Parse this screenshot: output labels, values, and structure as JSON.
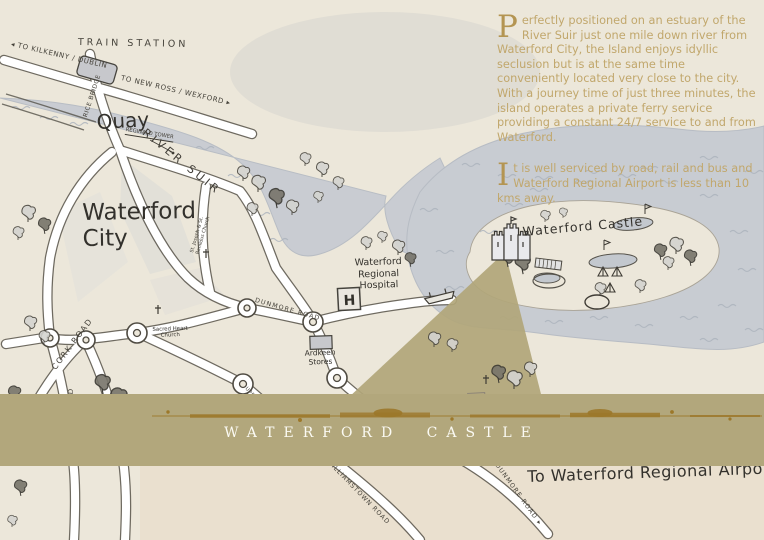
{
  "colors": {
    "background": "#ece7da",
    "water": "#c8ccd2",
    "wave": "#aab1bb",
    "road_fill": "#ffffff",
    "road_outline": "#4f4b42",
    "ink": "#33312c",
    "banner": "#b2a77c",
    "splatter": "#9c782a",
    "gold_text": "#c1a76c",
    "dropcap_gold": "#b49552"
  },
  "intro": {
    "para1_dropcap": "P",
    "para1_text": "erfectly positioned on an estuary of the River Suir just one mile down river from Waterford City, the Island enjoys idyllic seclusion but is at the same time conveniently located very close to the city.",
    "para1_text2": "With a journey time of just three minutes, the island operates a private ferry service providing a constant 24/7 service to and from Waterford.",
    "para2_dropcap": "I",
    "para2_text": "t is well serviced by road, rail and bus and Waterford Regional Airport is less than 10 kms away."
  },
  "banner": {
    "title": "WATERFORD CASTLE"
  },
  "map_labels": {
    "to_kilkenny": "◂ TO KILKENNY / DUBLIN",
    "train_station": "TRAIN STATION",
    "to_new_ross": "TO NEW ROSS / WEXFORD ▸",
    "rice_bridge": "RICE BRIDGE",
    "quay": "Quay",
    "reginald_tower": "REGINALD TOWER",
    "river_suir": "RIVER SUIR",
    "waterford_city_line1": "Waterford",
    "waterford_city_line2": "City",
    "cork_road": "CORK ROAD",
    "st_joseph_church": "St. Joseph & St. Benildus Church",
    "sacred_heart_church": "Sacred Heart Church",
    "dunmore_road_upper": "DUNMORE ROAD",
    "hospital_line1": "Waterford",
    "hospital_line2": "Regional",
    "hospital_line3": "Hospital",
    "hospital_h": "H",
    "ardkeen_line1": "Ardkeen",
    "ardkeen_line2": "Stores",
    "upper_grange_road": "UPPER GRANGE ROAD",
    "williamstown_road": "WILLIAMSTOWN ROAD",
    "dunmore_road_lower": "DUNMORE ROAD ▸",
    "tramore_road": "TRAMORE ROAD",
    "queens_pub": "queens pub",
    "waterford_castle": "Waterford Castle",
    "to_airport": "To Waterford Regional Airport"
  }
}
